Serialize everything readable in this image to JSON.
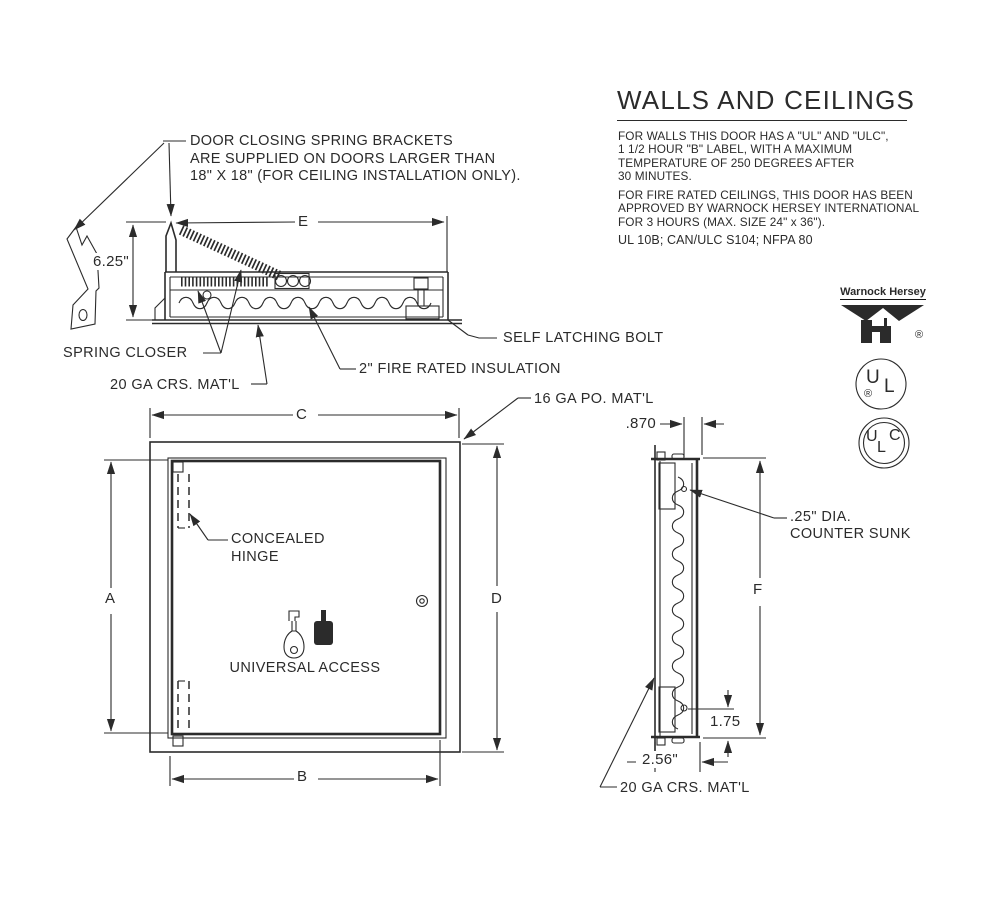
{
  "title_block": {
    "title": "WALLS AND CEILINGS",
    "para1": [
      "FOR WALLS THIS DOOR HAS A \"UL\" AND \"ULC\",",
      "1 1/2 HOUR \"B\" LABEL, WITH A MAXIMUM",
      "TEMPERATURE OF 250 DEGREES AFTER",
      "30 MINUTES."
    ],
    "para2": [
      "FOR FIRE RATED CEILINGS, THIS DOOR HAS BEEN",
      "APPROVED BY WARNOCK HERSEY INTERNATIONAL",
      "FOR 3 HOURS (MAX. SIZE 24\" x 36\")."
    ],
    "standards": "UL 10B; CAN/ULC S104; NFPA 80"
  },
  "note_top": {
    "line1": "DOOR CLOSING SPRING BRACKETS",
    "line2": "ARE SUPPLIED ON DOORS LARGER THAN",
    "line3": "18\" X 18\" (FOR CEILING INSTALLATION ONLY)."
  },
  "section_labels": {
    "spring_closer": "SPRING CLOSER",
    "mat_20ga": "20 GA CRS. MAT'L",
    "fire_insulation": "2\" FIRE RATED INSULATION",
    "self_latching_bolt": "SELF LATCHING BOLT",
    "mat_16ga": "16 GA PO. MAT'L"
  },
  "front_labels": {
    "concealed_hinge_line1": "CONCEALED",
    "concealed_hinge_line2": "HINGE",
    "universal_access": "UNIVERSAL ACCESS"
  },
  "side_labels": {
    "counter_sunk_line1": ".25\" DIA.",
    "counter_sunk_line2": "COUNTER SUNK",
    "mat_20ga": "20 GA CRS. MAT'L"
  },
  "dims": {
    "e": "E",
    "section_height": "6.25\"",
    "a": "A",
    "b": "B",
    "c": "C",
    "d": "D",
    "f": "F",
    "depth_top": ".870",
    "latch_offset": "1.75",
    "depth": "2.56\""
  },
  "logos": {
    "warnock": {
      "name": "Warnock Hersey",
      "registered": "®"
    },
    "ul": {
      "u": "U",
      "l": "L",
      "registered": "®"
    },
    "ulc": {
      "u": "U",
      "l": "L",
      "c": "C"
    }
  },
  "colors": {
    "ink": "#2b2b2b",
    "background": "#ffffff"
  }
}
